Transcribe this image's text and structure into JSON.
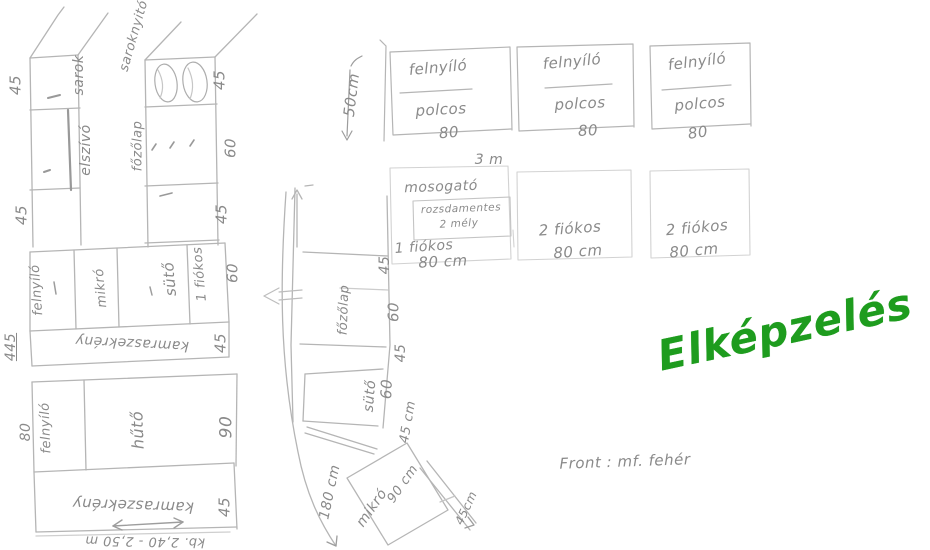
{
  "canvas": {
    "width": 930,
    "height": 550,
    "background": "#ffffff"
  },
  "colors": {
    "pencil_line": "#b5b5b5",
    "pencil_dark": "#999999",
    "pencil_faint": "#d2d2d2",
    "pencil_text": "#8a8a8a",
    "accent_green": "#1e9c1e"
  },
  "labels": [
    {
      "group": "top-cabinets",
      "name": "cabinet1-type-label",
      "text": "felnyíló",
      "x": 438,
      "y": 68,
      "rot": -5,
      "size": 15
    },
    {
      "group": "top-cabinets",
      "name": "cabinet1-shelf-label",
      "text": "polcos",
      "x": 441,
      "y": 110,
      "rot": -3,
      "size": 15
    },
    {
      "group": "top-cabinets",
      "name": "cabinet1-width",
      "text": "80",
      "x": 449,
      "y": 133,
      "rot": -5,
      "size": 15
    },
    {
      "group": "top-cabinets",
      "name": "cabinet2-type-label",
      "text": "felnyíló",
      "x": 572,
      "y": 62,
      "rot": -5,
      "size": 15
    },
    {
      "group": "top-cabinets",
      "name": "cabinet2-shelf-label",
      "text": "polcos",
      "x": 580,
      "y": 104,
      "rot": -3,
      "size": 15
    },
    {
      "group": "top-cabinets",
      "name": "cabinet2-width",
      "text": "80",
      "x": 588,
      "y": 131,
      "rot": -3,
      "size": 15
    },
    {
      "group": "top-cabinets",
      "name": "cabinet3-type-label",
      "text": "felnyíló",
      "x": 697,
      "y": 62,
      "rot": -7,
      "size": 15
    },
    {
      "group": "top-cabinets",
      "name": "cabinet3-shelf-label",
      "text": "polcos",
      "x": 700,
      "y": 104,
      "rot": -5,
      "size": 15
    },
    {
      "group": "top-cabinets",
      "name": "cabinet3-width",
      "text": "80",
      "x": 698,
      "y": 133,
      "rot": -8,
      "size": 15
    },
    {
      "group": "top-cabinets",
      "name": "cabinet-height-dim",
      "text": "50cm",
      "x": 352,
      "y": 95,
      "rot": -83,
      "size": 15
    },
    {
      "group": "sink-row",
      "name": "run-length-dim",
      "text": "3 m",
      "x": 489,
      "y": 160,
      "rot": 0,
      "size": 14
    },
    {
      "group": "sink-row",
      "name": "sink-label",
      "text": "mosogató",
      "x": 441,
      "y": 187,
      "rot": -2,
      "size": 14
    },
    {
      "group": "sink-row",
      "name": "sink-material-label",
      "text": "rozsdamentes",
      "x": 461,
      "y": 209,
      "rot": -2,
      "size": 10.5
    },
    {
      "group": "sink-row",
      "name": "sink-depth-label",
      "text": "2 mély",
      "x": 459,
      "y": 224,
      "rot": -3,
      "size": 10.5
    },
    {
      "group": "sink-row",
      "name": "unit1-drawer-label",
      "text": "1 fiókos",
      "x": 424,
      "y": 247,
      "rot": -4,
      "size": 14
    },
    {
      "group": "sink-row",
      "name": "unit1-width",
      "text": "80 cm",
      "x": 443,
      "y": 262,
      "rot": -3,
      "size": 15
    },
    {
      "group": "sink-row",
      "name": "unit2-drawer-label",
      "text": "2 fiókos",
      "x": 570,
      "y": 229,
      "rot": -4,
      "size": 15
    },
    {
      "group": "sink-row",
      "name": "unit2-width",
      "text": "80 cm",
      "x": 578,
      "y": 252,
      "rot": -4,
      "size": 15
    },
    {
      "group": "sink-row",
      "name": "unit3-drawer-label",
      "text": "2 fiókos",
      "x": 697,
      "y": 228,
      "rot": -5,
      "size": 15
    },
    {
      "group": "sink-row",
      "name": "unit3-width",
      "text": "80 cm",
      "x": 694,
      "y": 251,
      "rot": -5,
      "size": 15
    },
    {
      "group": "left-plan",
      "name": "dim-45-top-left",
      "text": "45",
      "x": 16,
      "y": 85,
      "rot": -90,
      "size": 15
    },
    {
      "group": "left-plan",
      "name": "corner-label",
      "text": "sarok",
      "x": 79,
      "y": 75,
      "rot": -90,
      "size": 14
    },
    {
      "group": "left-plan",
      "name": "hood-label",
      "text": "elszívó",
      "x": 86,
      "y": 150,
      "rot": -90,
      "size": 14
    },
    {
      "group": "left-plan",
      "name": "corner-unit-label",
      "text": "saroknyitó",
      "x": 134,
      "y": 36,
      "rot": -74,
      "size": 13
    },
    {
      "group": "left-plan",
      "name": "dim-45-col2-top",
      "text": "45",
      "x": 220,
      "y": 80,
      "rot": -90,
      "size": 15
    },
    {
      "group": "left-plan",
      "name": "hob1-label",
      "text": "főzőlap",
      "x": 138,
      "y": 146,
      "rot": -90,
      "size": 13
    },
    {
      "group": "left-plan",
      "name": "dim-60-col2",
      "text": "60",
      "x": 231,
      "y": 148,
      "rot": -90,
      "size": 15
    },
    {
      "group": "left-plan",
      "name": "dim-45-left-mid",
      "text": "45",
      "x": 22,
      "y": 215,
      "rot": -90,
      "size": 15
    },
    {
      "group": "left-plan",
      "name": "dim-45-col2-mid",
      "text": "45",
      "x": 222,
      "y": 214,
      "rot": -90,
      "size": 15
    },
    {
      "group": "left-plan",
      "name": "row-flipup-label",
      "text": "felnyíló",
      "x": 37,
      "y": 290,
      "rot": -94,
      "size": 13
    },
    {
      "group": "left-plan",
      "name": "microwave-label",
      "text": "mikró",
      "x": 101,
      "y": 288,
      "rot": -95,
      "size": 13
    },
    {
      "group": "left-plan",
      "name": "oven1-label",
      "text": "sütő",
      "x": 170,
      "y": 279,
      "rot": -95,
      "size": 15
    },
    {
      "group": "left-plan",
      "name": "row-drawer-label",
      "text": "1 fiókos",
      "x": 200,
      "y": 274,
      "rot": -95,
      "size": 13
    },
    {
      "group": "left-plan",
      "name": "dim-60-row",
      "text": "60",
      "x": 233,
      "y": 273,
      "rot": -90,
      "size": 15
    },
    {
      "group": "left-plan",
      "name": "dim-445-total",
      "text": "445",
      "x": 11,
      "y": 347,
      "rot": -90,
      "size": 14,
      "underline": true
    },
    {
      "group": "left-plan",
      "name": "pantry1-label",
      "text": "kamraszekrény",
      "x": 132,
      "y": 343,
      "rot": 183,
      "size": 14
    },
    {
      "group": "left-plan",
      "name": "dim-45-pantry1",
      "text": "45",
      "x": 221,
      "y": 343,
      "rot": -90,
      "size": 15
    },
    {
      "group": "left-plan",
      "name": "dim-80-bottom",
      "text": "80",
      "x": 26,
      "y": 432,
      "rot": -90,
      "size": 14
    },
    {
      "group": "left-plan",
      "name": "flipup-bottom-label",
      "text": "felnyíló",
      "x": 46,
      "y": 428,
      "rot": -92,
      "size": 13
    },
    {
      "group": "left-plan",
      "name": "fridge-label",
      "text": "hűtő",
      "x": 138,
      "y": 430,
      "rot": -92,
      "size": 16
    },
    {
      "group": "left-plan",
      "name": "dim-90-fridge",
      "text": "90",
      "x": 227,
      "y": 427,
      "rot": -90,
      "size": 17
    },
    {
      "group": "left-plan",
      "name": "pantry2-label",
      "text": "kamraszekrény",
      "x": 133,
      "y": 505,
      "rot": 182,
      "size": 15
    },
    {
      "group": "left-plan",
      "name": "dim-45-pantry2",
      "text": "45",
      "x": 225,
      "y": 507,
      "rot": -90,
      "size": 15
    },
    {
      "group": "left-plan",
      "name": "length-note",
      "text": "kb. 2,40 - 2,50 m",
      "x": 145,
      "y": 541,
      "rot": 181,
      "size": 13
    },
    {
      "group": "middle-plan",
      "name": "hob2-label",
      "text": "főzőlap",
      "x": 344,
      "y": 310,
      "rot": -88,
      "size": 13
    },
    {
      "group": "middle-plan",
      "name": "dim-45-strip1",
      "text": "45",
      "x": 385,
      "y": 265,
      "rot": -90,
      "size": 14
    },
    {
      "group": "middle-plan",
      "name": "dim-60-strip",
      "text": "60",
      "x": 394,
      "y": 312,
      "rot": -90,
      "size": 15
    },
    {
      "group": "middle-plan",
      "name": "dim-45-strip2",
      "text": "45",
      "x": 401,
      "y": 353,
      "rot": -90,
      "size": 14
    },
    {
      "group": "middle-plan",
      "name": "oven2-label",
      "text": "sütő",
      "x": 370,
      "y": 396,
      "rot": -85,
      "size": 14
    },
    {
      "group": "middle-plan",
      "name": "dim-60-oven",
      "text": "60",
      "x": 387,
      "y": 389,
      "rot": -88,
      "size": 15
    },
    {
      "group": "middle-plan",
      "name": "dim-45cm-oven",
      "text": "45 cm",
      "x": 408,
      "y": 422,
      "rot": -80,
      "size": 13
    },
    {
      "group": "middle-plan",
      "name": "dim-180cm-wall",
      "text": "180 cm",
      "x": 330,
      "y": 492,
      "rot": -78,
      "size": 14
    },
    {
      "group": "middle-plan",
      "name": "microwave2-label",
      "text": "mikró",
      "x": 372,
      "y": 508,
      "rot": -55,
      "size": 14
    },
    {
      "group": "middle-plan",
      "name": "dim-90cm-diag",
      "text": "90 cm",
      "x": 403,
      "y": 484,
      "rot": -55,
      "size": 13
    },
    {
      "group": "middle-plan",
      "name": "dim-45cm-diag",
      "text": "45cm",
      "x": 466,
      "y": 508,
      "rot": -65,
      "size": 12
    },
    {
      "group": "notes",
      "name": "front-finish-note",
      "text": "Front : mf. fehér",
      "x": 625,
      "y": 462,
      "rot": -2,
      "size": 15
    },
    {
      "group": "notes",
      "name": "concept-title",
      "text": "Elképzelés",
      "x": 785,
      "y": 330,
      "rot": -12,
      "size": 42,
      "color": "accent_green",
      "title": true
    }
  ]
}
